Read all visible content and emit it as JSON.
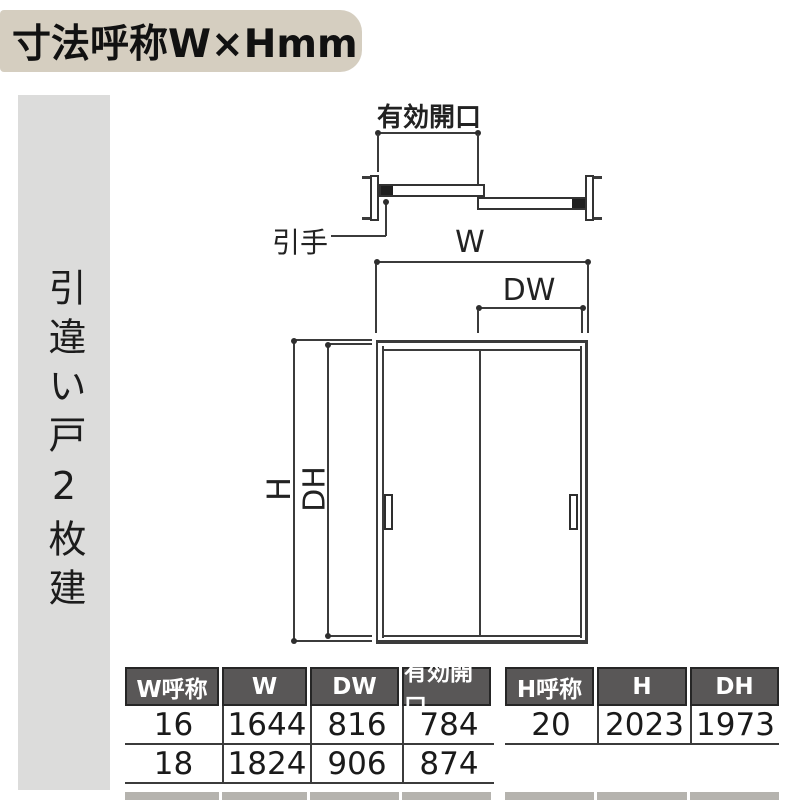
{
  "title": {
    "text": "寸法呼称W×Hmm"
  },
  "sidebar": {
    "label": "引違い戸2枚建"
  },
  "plan_view": {
    "opening_label": "有効開口",
    "handle_label": "引手",
    "width_label": "W"
  },
  "front_view": {
    "door_width_label": "DW",
    "height_label": "H",
    "door_height_label": "DH"
  },
  "tables": {
    "w_table": {
      "headers": [
        "W呼称",
        "W",
        "DW",
        "有効開口"
      ],
      "rows": [
        [
          "16",
          "1644",
          "816",
          "784"
        ],
        [
          "18",
          "1824",
          "906",
          "874"
        ]
      ]
    },
    "h_table": {
      "headers": [
        "H呼称",
        "H",
        "DH"
      ],
      "rows": [
        [
          "20",
          "2023",
          "1973"
        ]
      ]
    }
  },
  "colors": {
    "title_bg": "#d5cec0",
    "sidebar_bg": "#dcdcdb",
    "table_header_bg": "#595757",
    "table_header_text": "#ffffff",
    "diagram_line": "#3b3b3b"
  }
}
